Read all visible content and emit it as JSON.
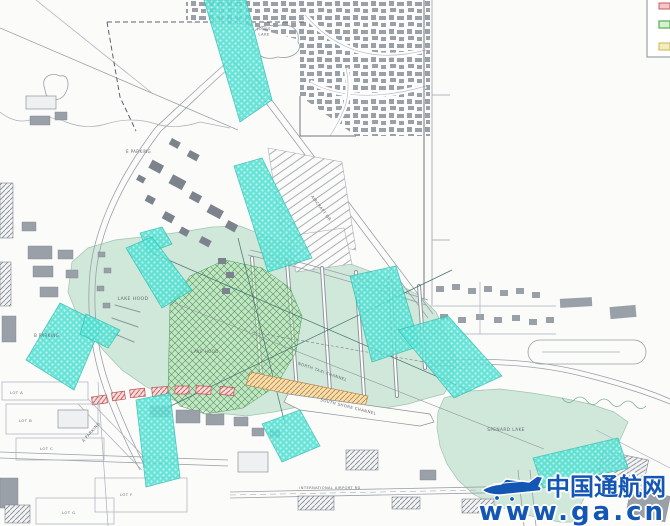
{
  "drawing": {
    "type": "seaplane-base site plan",
    "labels": {
      "jones_lake_line1": "JONES",
      "jones_lake_line2": "LAKE",
      "e_parking": "E PARKING",
      "b_parking": "B PARKING",
      "a_parking": "A PARKING",
      "lake_hood": "LAKE HOOD",
      "lake_hood_east": "LAKE HOOD",
      "north_taxi_channel": "NORTH TAXI CHANNEL",
      "south_shore_channel": "SOUTH SHORE CHANNEL",
      "spenard_lake": "SPENARD LAKE",
      "aircraft_dr": "AIRCRAFT DR",
      "intl_airport_rd": "INTERNATIONAL AIRPORT RD",
      "lot_a": "LOT A",
      "lot_b": "LOT B",
      "lot_c": "LOT C",
      "lot_f": "LOT F",
      "lot_g": "LOT G"
    },
    "colors": {
      "water": "#cfe8da",
      "water_lane_teal": "#4ee0d2",
      "operating_area_green": "#4a9a55",
      "runway_strip_orange": "#f4dfae",
      "building_highlight_red": "#c05050",
      "linework_grey": "#9aa0a8"
    },
    "legend_swatches": [
      {
        "name": "red-swatch",
        "color": "#cc5a5a"
      },
      {
        "name": "green-swatch",
        "color": "#5ab55a"
      },
      {
        "name": "yellow-swatch",
        "color": "#c8b84a"
      }
    ]
  },
  "watermark": {
    "brand": "中国通航网",
    "url": "www.ga.cn",
    "color": "#1456b4"
  }
}
